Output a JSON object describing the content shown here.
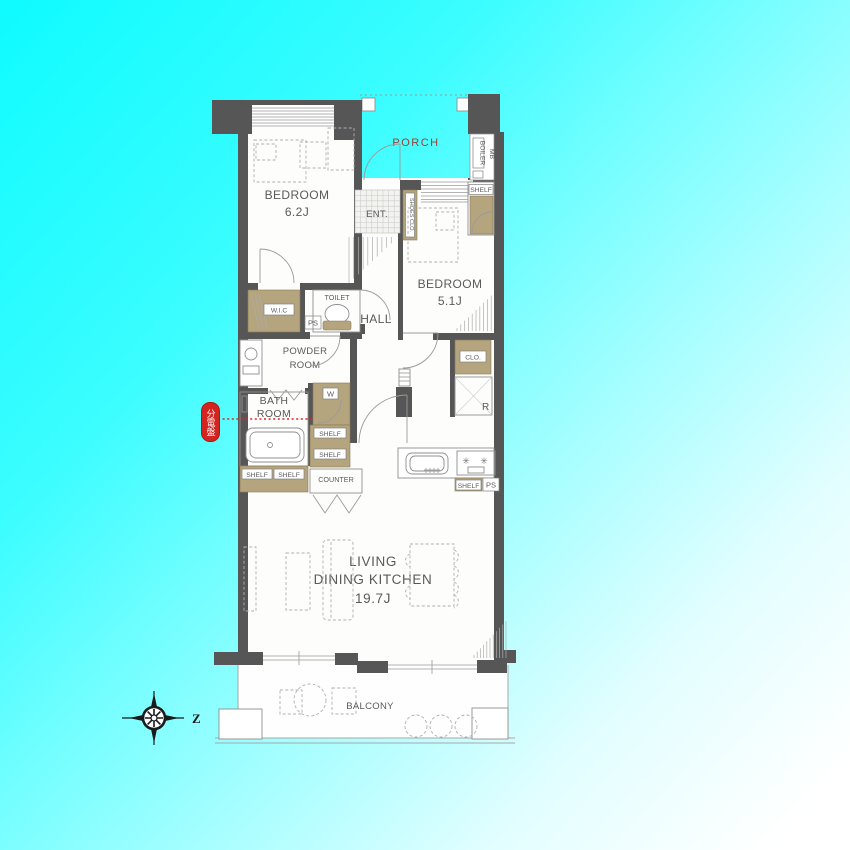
{
  "plan": {
    "porch_label": "PORCH",
    "boiler_label": "BOILER",
    "mb_label": "MB",
    "shelf_label": "SHELF",
    "shoes_closet_label": "SHOES CLO.",
    "entrance_label": "ENT.",
    "bedroom1": {
      "name": "BEDROOM",
      "size": "6.2J"
    },
    "bedroom2": {
      "name": "BEDROOM",
      "size": "5.1J"
    },
    "wic_label": "W.I.C",
    "ps_label": "PS",
    "toilet_label": "TOILET",
    "hall_label": "HALL",
    "powder_room": {
      "line1": "POWDER",
      "line2": "ROOM"
    },
    "bath_room": {
      "line1": "BATH",
      "line2": "ROOM"
    },
    "washer_label": "W",
    "counter_label": "COUNTER",
    "closet_label": "CLO.",
    "fridge_label": "R",
    "kitchen_ps_label": "PS",
    "ldk": {
      "line1": "LIVING",
      "line2": "DINING KITCHEN",
      "size": "19.7J"
    },
    "balcony_label": "BALCONY",
    "compass_letter": "Z",
    "panel_badge_label": "分電盤"
  },
  "colors": {
    "wall": "#565656",
    "cabinet_tan": "#b5a57e",
    "badge_red": "#d42420",
    "porch_text": "#9b4136",
    "background_cyan": "#0efbff",
    "background_fade": "#ffffff"
  }
}
